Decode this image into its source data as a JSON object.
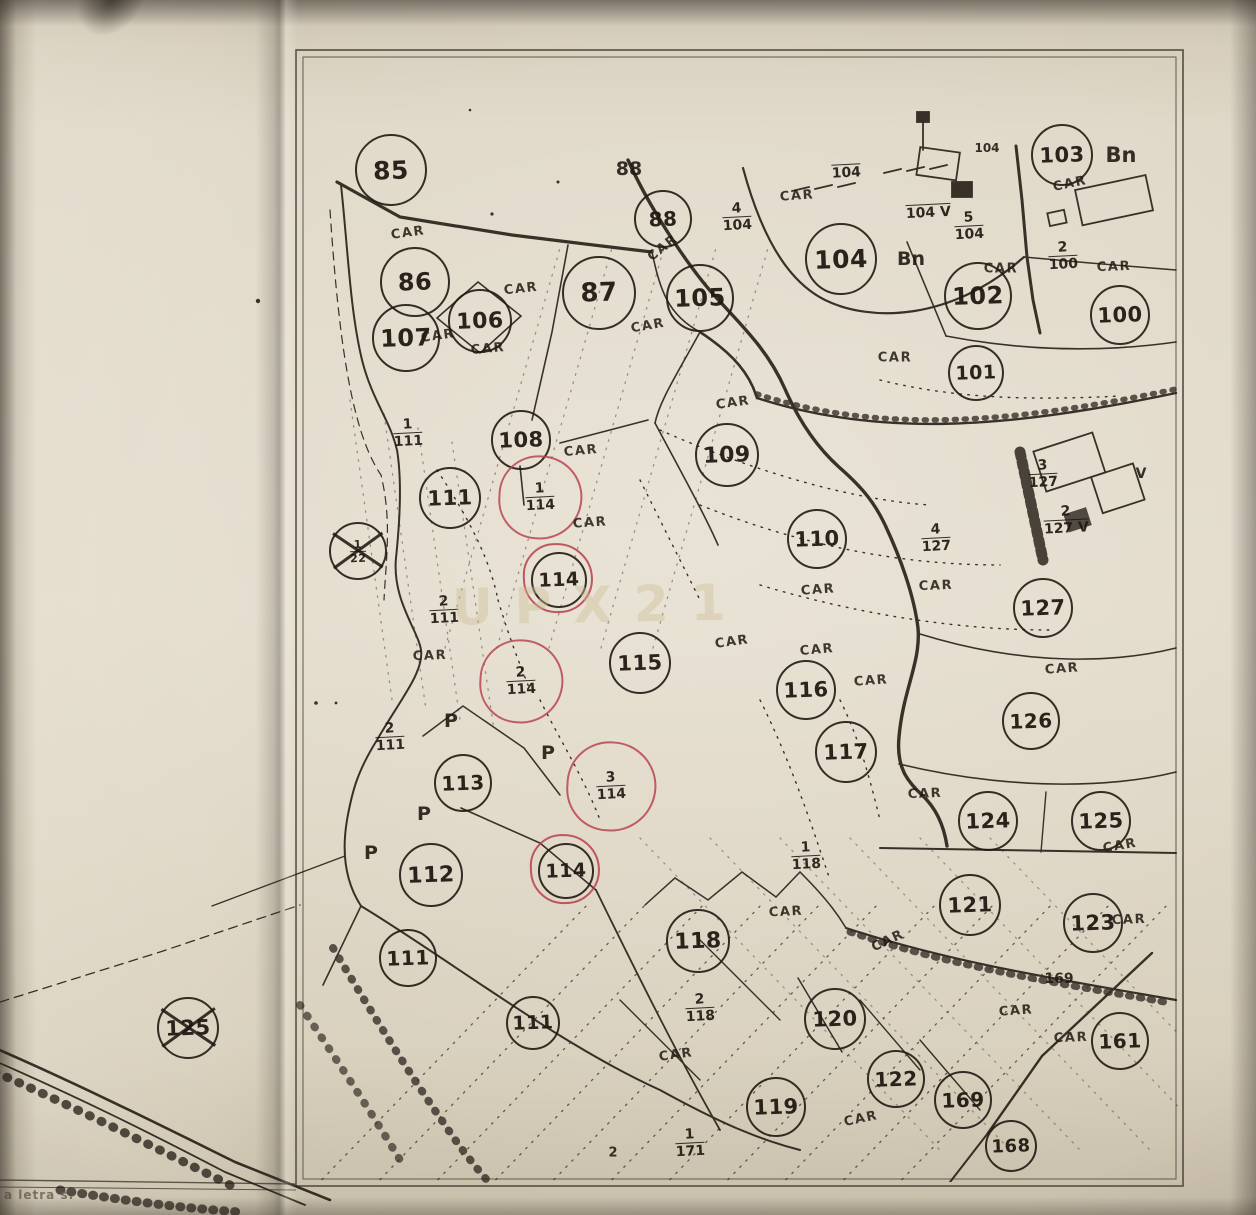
{
  "document": {
    "margin_note": "a letra s.",
    "watermark": "UPX21"
  },
  "map": {
    "ink_color": "#221c15",
    "red_ink_color": "#b73e4c",
    "car_text": "CAR",
    "parcels": [
      {
        "label": "85",
        "x": 389,
        "y": 168,
        "r": 34
      },
      {
        "label": "86",
        "x": 413,
        "y": 280,
        "r": 33
      },
      {
        "label": "107",
        "x": 404,
        "y": 336,
        "r": 32
      },
      {
        "label": "106",
        "x": 478,
        "y": 319,
        "r": 30
      },
      {
        "label": "87",
        "x": 597,
        "y": 291,
        "r": 35
      },
      {
        "label": "88",
        "x": 661,
        "y": 217,
        "r": 27
      },
      {
        "label": "105",
        "x": 698,
        "y": 296,
        "r": 32
      },
      {
        "label": "104",
        "x": 839,
        "y": 257,
        "r": 34
      },
      {
        "label": "103",
        "x": 1060,
        "y": 153,
        "r": 29
      },
      {
        "label": "102",
        "x": 976,
        "y": 294,
        "r": 32
      },
      {
        "label": "100",
        "x": 1118,
        "y": 313,
        "r": 28
      },
      {
        "label": "101",
        "x": 974,
        "y": 371,
        "r": 26
      },
      {
        "label": "108",
        "x": 519,
        "y": 438,
        "r": 28
      },
      {
        "label": "109",
        "x": 725,
        "y": 453,
        "r": 30
      },
      {
        "label": "111",
        "x": 448,
        "y": 496,
        "r": 29
      },
      {
        "label": "110",
        "x": 815,
        "y": 537,
        "r": 28
      },
      {
        "label": "127",
        "x": 1041,
        "y": 606,
        "r": 28
      },
      {
        "label": "115",
        "x": 638,
        "y": 661,
        "r": 29
      },
      {
        "label": "116",
        "x": 804,
        "y": 688,
        "r": 28
      },
      {
        "label": "126",
        "x": 1029,
        "y": 719,
        "r": 27
      },
      {
        "label": "117",
        "x": 844,
        "y": 750,
        "r": 29
      },
      {
        "label": "113",
        "x": 461,
        "y": 781,
        "r": 27
      },
      {
        "label": "124",
        "x": 986,
        "y": 819,
        "r": 28
      },
      {
        "label": "125",
        "x": 1099,
        "y": 819,
        "r": 28
      },
      {
        "label": "112",
        "x": 429,
        "y": 873,
        "r": 30
      },
      {
        "label": "114",
        "x": 557,
        "y": 578,
        "r": 26,
        "red_ring": true
      },
      {
        "label": "114",
        "x": 564,
        "y": 869,
        "r": 26,
        "red_ring": true
      },
      {
        "label": "118",
        "x": 696,
        "y": 939,
        "r": 30
      },
      {
        "label": "121",
        "x": 968,
        "y": 903,
        "r": 29
      },
      {
        "label": "123",
        "x": 1091,
        "y": 921,
        "r": 28
      },
      {
        "label": "111",
        "x": 406,
        "y": 956,
        "r": 27
      },
      {
        "label": "111",
        "x": 531,
        "y": 1021,
        "r": 25
      },
      {
        "label": "120",
        "x": 833,
        "y": 1017,
        "r": 29
      },
      {
        "label": "122",
        "x": 894,
        "y": 1077,
        "r": 27
      },
      {
        "label": "169",
        "x": 961,
        "y": 1098,
        "r": 27
      },
      {
        "label": "161",
        "x": 1118,
        "y": 1039,
        "r": 27
      },
      {
        "label": "119",
        "x": 774,
        "y": 1105,
        "r": 28
      },
      {
        "label": "168",
        "x": 1009,
        "y": 1144,
        "r": 24
      },
      {
        "label": "125",
        "x": 186,
        "y": 1026,
        "r": 29,
        "crossed": true
      },
      {
        "label": "",
        "x": 356,
        "y": 549,
        "r": 27,
        "crossed": true,
        "fraction": {
          "num": "1",
          "den": "22"
        }
      }
    ],
    "fractions": [
      {
        "num": "4",
        "den": "104",
        "x": 737,
        "y": 217
      },
      {
        "num": "5",
        "den": "104",
        "x": 969,
        "y": 226
      },
      {
        "num": "",
        "den": "104",
        "x": 846,
        "y": 166
      },
      {
        "num": "",
        "den": "104",
        "x": 928,
        "y": 206,
        "suffix": " V"
      },
      {
        "num": "2",
        "den": "100",
        "x": 1063,
        "y": 256
      },
      {
        "num": "4",
        "den": "127",
        "x": 936,
        "y": 538
      },
      {
        "num": "3",
        "den": "127",
        "x": 1043,
        "y": 474
      },
      {
        "num": "2",
        "den": "127",
        "x": 1066,
        "y": 520,
        "suffix": " V"
      },
      {
        "num": "1",
        "den": "111",
        "x": 408,
        "y": 433
      },
      {
        "num": "2",
        "den": "111",
        "x": 444,
        "y": 610
      },
      {
        "num": "2",
        "den": "111",
        "x": 390,
        "y": 737
      },
      {
        "num": "1",
        "den": "114",
        "x": 540,
        "y": 497,
        "red_ring": 40
      },
      {
        "num": "2",
        "den": "114",
        "x": 521,
        "y": 681,
        "red_ring": 40
      },
      {
        "num": "3",
        "den": "114",
        "x": 611,
        "y": 786,
        "red_ring": 43
      },
      {
        "num": "1",
        "den": "118",
        "x": 806,
        "y": 856
      },
      {
        "num": "2",
        "den": "118",
        "x": 700,
        "y": 1008
      },
      {
        "num": "1",
        "den": "171",
        "x": 690,
        "y": 1143
      }
    ],
    "car_labels": [
      {
        "x": 408,
        "y": 233,
        "rot": -8
      },
      {
        "x": 521,
        "y": 289,
        "rot": -6
      },
      {
        "x": 663,
        "y": 248,
        "rot": -38
      },
      {
        "x": 648,
        "y": 326,
        "rot": -10
      },
      {
        "x": 438,
        "y": 336,
        "rot": -8
      },
      {
        "x": 488,
        "y": 349,
        "rot": -5
      },
      {
        "x": 797,
        "y": 196,
        "rot": -4
      },
      {
        "x": 1070,
        "y": 184,
        "rot": -12
      },
      {
        "x": 1001,
        "y": 269,
        "rot": 0
      },
      {
        "x": 1114,
        "y": 267,
        "rot": -2
      },
      {
        "x": 895,
        "y": 358,
        "rot": 0
      },
      {
        "x": 733,
        "y": 403,
        "rot": -8
      },
      {
        "x": 581,
        "y": 451,
        "rot": -5
      },
      {
        "x": 590,
        "y": 523,
        "rot": -4
      },
      {
        "x": 430,
        "y": 656,
        "rot": -2
      },
      {
        "x": 732,
        "y": 642,
        "rot": -8
      },
      {
        "x": 817,
        "y": 650,
        "rot": -5
      },
      {
        "x": 871,
        "y": 681,
        "rot": -4
      },
      {
        "x": 818,
        "y": 590,
        "rot": -4
      },
      {
        "x": 936,
        "y": 586,
        "rot": -2
      },
      {
        "x": 1062,
        "y": 669,
        "rot": -4
      },
      {
        "x": 925,
        "y": 794,
        "rot": -2
      },
      {
        "x": 1120,
        "y": 846,
        "rot": -10
      },
      {
        "x": 1129,
        "y": 920,
        "rot": -2
      },
      {
        "x": 786,
        "y": 912,
        "rot": -3
      },
      {
        "x": 888,
        "y": 941,
        "rot": -25
      },
      {
        "x": 676,
        "y": 1055,
        "rot": -8
      },
      {
        "x": 861,
        "y": 1119,
        "rot": -12
      },
      {
        "x": 1016,
        "y": 1011,
        "rot": -4
      },
      {
        "x": 1071,
        "y": 1038,
        "rot": -2
      }
    ],
    "labels": [
      {
        "text": "Bn",
        "x": 1121,
        "y": 155,
        "size": 21
      },
      {
        "text": "Bn",
        "x": 911,
        "y": 259,
        "size": 19
      },
      {
        "text": "P",
        "x": 451,
        "y": 721,
        "size": 19
      },
      {
        "text": "P",
        "x": 548,
        "y": 753,
        "size": 19
      },
      {
        "text": "P",
        "x": 424,
        "y": 814,
        "size": 19
      },
      {
        "text": "P",
        "x": 371,
        "y": 853,
        "size": 19
      },
      {
        "text": "V",
        "x": 1141,
        "y": 474,
        "size": 14
      },
      {
        "text": "104",
        "x": 987,
        "y": 148,
        "size": 12
      },
      {
        "text": "88",
        "x": 629,
        "y": 169,
        "size": 19
      },
      {
        "text": "169",
        "x": 1059,
        "y": 979,
        "size": 14
      },
      {
        "text": "2",
        "x": 613,
        "y": 1153,
        "size": 13
      }
    ]
  }
}
